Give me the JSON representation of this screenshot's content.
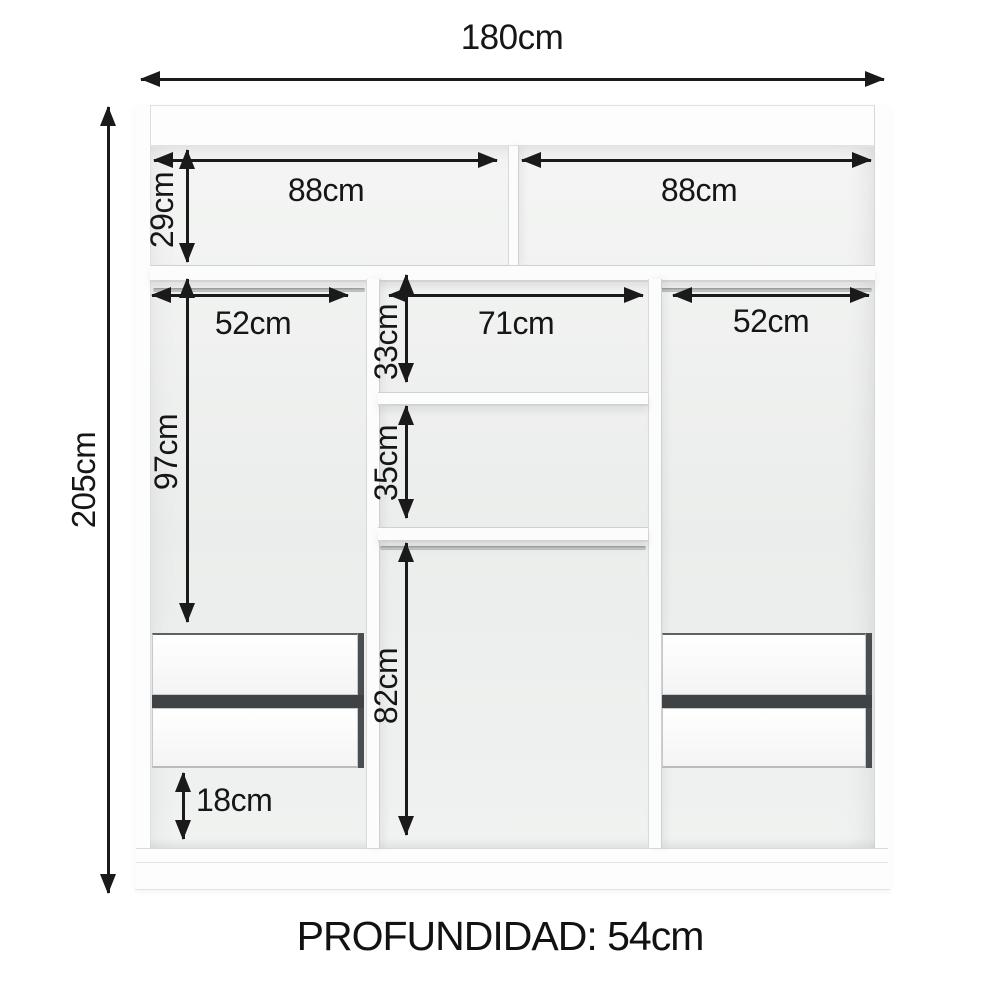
{
  "diagram": {
    "kind": "wardrobe-internal-dimensions",
    "footer": {
      "depth_label": "PROFUNDIDAD: 54cm"
    },
    "dims": {
      "total_width": "180cm",
      "total_height": "205cm",
      "top_left_compartment_width": "88cm",
      "top_right_compartment_width": "88cm",
      "top_compartment_height": "29cm",
      "left_column_width": "52cm",
      "center_column_width": "71cm",
      "right_column_width": "52cm",
      "center_upper_section_height": "33cm",
      "center_shelf_section_height": "35cm",
      "left_hanging_space_height": "97cm",
      "center_hanging_space_height": "82cm",
      "bottom_space_height": "18cm"
    },
    "colors": {
      "arrow": "#1a1a1a",
      "cabinet_white": "#fcfdfc",
      "interior_grey": "#eceeed",
      "drawer_gap_dark": "#3f4345",
      "rod_grey": "#aeb2b1"
    }
  }
}
